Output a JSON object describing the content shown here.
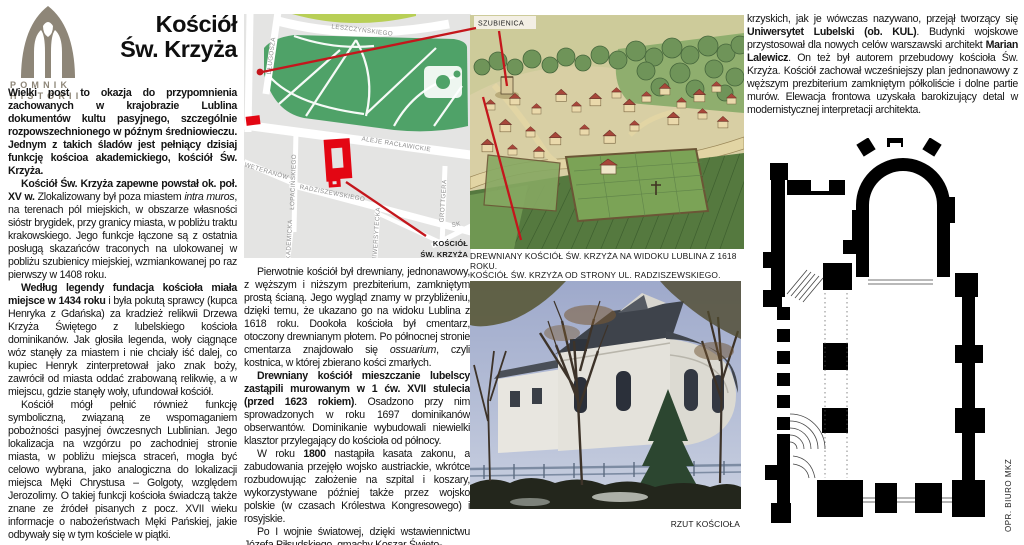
{
  "colors": {
    "accent_red": "#c4161c",
    "map_red": "#e30613",
    "logo_gray": "#8e8678",
    "park_green": "#4fa268",
    "map_bg": "#e4e4e3"
  },
  "logo": {
    "line1": "POMNIK",
    "line2": "HISTORII"
  },
  "title": {
    "line1": "Kościół",
    "line2": "Św. Krzyża"
  },
  "article": {
    "left": {
      "p1": [
        {
          "t": "Wielki post to okazja do przypomnienia zachowanych w krajobrazie Lublina dokumentów kultu pasyjnego, szczególnie rozpowszechnionego w późnym średniowieczu. Jednym z takich śladów jest pełniący dzisiaj funkcję kościoa akademickiego, kościół Św. Krzyża.",
          "s": "b"
        }
      ],
      "p2": [
        {
          "t": "Kościół Św. Krzyża zapewne powstał ok. poł. XV w. ",
          "s": "b"
        },
        {
          "t": "Zlokalizowany był poza miastem ",
          "s": ""
        },
        {
          "t": "intra muros",
          "s": "i"
        },
        {
          "t": ", na terenach pól miejskich, w obszarze własności sióstr brygidek, przy granicy miasta, w pobliżu traktu krakowskiego. Jego funkcje łączone są z ostatnia posługą skazańców traconych na ulokowanej w pobliżu szubienicy miejskiej, wzmiankowanej po raz pierwszy w 1408 roku.",
          "s": ""
        }
      ],
      "p3": [
        {
          "t": "Według legendy fundacja kościoła miała miejsce w 1434 roku ",
          "s": "b"
        },
        {
          "t": "i była pokutą sprawcy (kupca Henryka z Gdańska) za kradzież relikwii Drzewa Krzyża Świętego z lubelskiego kościoła dominikanów. Jak głosiła legenda, woły ciągnące wóz stanęły za miastem i nie chciały iść dalej, co kupiec Henryk zinterpretował jako znak boży, zawrócił od miasta oddać zrabowaną relikwię, a w miejscu, gdzie stanęły woły, ufundował kościół.",
          "s": ""
        }
      ],
      "p4": [
        {
          "t": "Kościół mógł pełnić również funkcję symboliczną, związaną ze wspomaganiem pobożności pasyjnej ówczesnych Lublinian. Jego lokalizacja na wzgórzu po zachodniej stronie miasta, w pobliżu miejsca straceń, mogła być celowo wybrana, jako analogiczna do lokalizacji miejsca Męki Chrystusa – Golgoty, względem Jerozolimy. O takiej funkcji kościoła świadczą także znane ze źródeł pisanych z pocz. XVII wieku informacje o nabożeństwach Męki Pańskiej, jakie odbywały się w tym kościele w piątki.",
          "s": ""
        }
      ]
    },
    "middle": {
      "p1": [
        {
          "t": "Pierwotnie kościół był drewniany, jednonawowy, z węższym i niższym prezbiterium, zamkniętym prostą ścianą. Jego wygląd znamy w przybliżeniu, dzięki temu, że ukazano go na widoku Lublina z 1618 roku. Dookoła kościoła był cmentarz, otoczony drewnianym płotem. Po północnej stronie cmentarza znajdowało się ",
          "s": ""
        },
        {
          "t": "ossuarium",
          "s": "i"
        },
        {
          "t": ", czyli kostnica, w której zbierano kości zmarłych.",
          "s": ""
        }
      ],
      "p2": [
        {
          "t": "Drewniany kościół mieszczanie lubelscy zastąpili murowanym w 1 ćw. XVII stulecia (przed 1623 rokiem)",
          "s": "b"
        },
        {
          "t": ". Osadzono przy nim sprowadzonych w roku 1697 dominikanów obserwantów. Dominikanie wybudowali niewielki klasztor przylegający do kościoła od północy.",
          "s": ""
        }
      ],
      "p3": [
        {
          "t": "W roku ",
          "s": ""
        },
        {
          "t": "1800",
          "s": "b"
        },
        {
          "t": " nastąpiła kasata zakonu, a zabudowania przejęło wojsko austriackie, wkrótce rozbudowując założenie na szpital i koszary, wykorzystywane później także przez wojsko polskie (w czasach Królestwa Kongresowego) i rosyjskie.",
          "s": ""
        }
      ],
      "p4": [
        {
          "t": "Po I wojnie światowej, dzięki wstawiennictwu Józefa Piłsudskiego, gmachy Koszar Święto-",
          "s": ""
        }
      ]
    },
    "right": {
      "p1": [
        {
          "t": "krzyskich, jak je wówczas nazywano, przejął tworzący się ",
          "s": ""
        },
        {
          "t": "Uniwersytet Lubelski (ob. KUL)",
          "s": "b"
        },
        {
          "t": ". Budynki wojskowe przystosował dla nowych celów warszawski architekt ",
          "s": ""
        },
        {
          "t": "Marian Lalewicz",
          "s": "b"
        },
        {
          "t": ". On też był autorem przebudowy kościoła Św. Krzyża. Kościół zachował wcześniejszy plan jednonawowy z węższym prezbiterium zamkniętym półkoliście i dolne partie murów. Elewacja frontowa uzyskała barokizujący detal w modernistycznej interpretacji architekta.",
          "s": ""
        }
      ]
    }
  },
  "map": {
    "streets": {
      "leszczynskiego": "LESZCZYŃSKIEGO",
      "dlugosza": "DŁUGOSZA",
      "aleje": "ALEJE RACŁAWICKIE",
      "weteranow": "WETERANÓW",
      "lopacinskiego": "ŁOPACIŃSKIEGO",
      "radziszewskiego": "RADZISZEWSKIEGO",
      "grottgera": "GROTTGERA",
      "uniwersytecka": "UNIWERSYTECKA",
      "akademicka": "AKADEMICKA",
      "sk": "SK"
    },
    "church_label_line1": "KOŚCIÓŁ",
    "church_label_line2": "ŚW. KRZYŻA"
  },
  "figures": {
    "szubienica_label": "SZUBIENICA",
    "caption_painting": "DREWNIANY KOŚCIÓŁ ŚW. KRZYŻA NA WIDOKU LUBLINA Z 1618 ROKU.",
    "caption_photo": "KOŚCIÓŁ ŚW. KRZYŻA OD STRONY UL. RADZISZEWSKIEGO.",
    "caption_plan": "RZUT KOŚCIOŁA",
    "credit": "OPR. BIURO MKZ"
  }
}
